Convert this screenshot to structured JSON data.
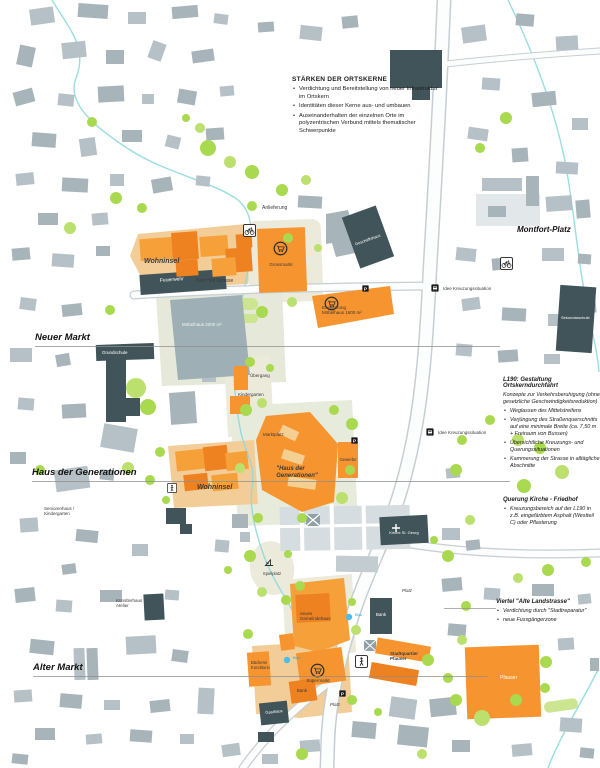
{
  "annotations": {
    "staerken": {
      "title": "STÄRKEN DER ORTSKERNE",
      "bullets": [
        "Verdichtung und Bereitstellung von neuer Infrastruktur im Ortskern",
        "Identitäten dieser Kerne aus- und umbauen",
        "Auseinanderhalten der einzelnen Orte im polyzentrischen Verbund mittels thematischer Schwerpunkte"
      ]
    },
    "l190": {
      "title": "L190: Gestaltung Ortskerndurchfahrt",
      "intro": "Konzepte zur Verkehrsberuhigung (ohne gesetzliche Geschwindigkeitsreduktion)",
      "bullets": [
        "Weglassen des Mittelstreifens",
        "Verjüngung des Straßenquerschnitts auf eine minimale Breite (ca. 7,50 m + Freiraum von Bussen)",
        "Übersichtliche Kreuzungs- und Querungssituationen",
        "Kammerung der Strasse in alltägliche Abschnitte"
      ]
    },
    "querung": {
      "title": "Querung Kirche - Friedhof",
      "bullets": [
        "Kreuzungsbereich auf der L190 in z.B. eingefärbtem Asphalt (Westteil C) oder Pflasterung"
      ]
    },
    "viertel": {
      "title": "Viertel \"Alte Landstrasse\"",
      "bullets": [
        "Verdichtung durch \"Stadtreparatur\"",
        "neue Fussgängerzone"
      ]
    }
  },
  "district_labels": [
    {
      "id": "neuer-markt",
      "t": "Neuer Markt",
      "x": 35,
      "y": 333,
      "lw": 465
    },
    {
      "id": "haus-der-generationen",
      "t": "Haus der Generationen",
      "x": 32,
      "y": 468,
      "lw": 478
    },
    {
      "id": "alter-markt",
      "t": "Alter Markt",
      "x": 33,
      "y": 663,
      "lw": 455
    },
    {
      "id": "montfort-platz",
      "t": "Montfort-Platz",
      "x": 517,
      "y": 226,
      "lw": 0,
      "small": 1
    }
  ],
  "map_labels": [
    {
      "t": "Feuerwehr",
      "x": 160,
      "y": 278,
      "s": 5,
      "c": "#ffffff",
      "r": -4
    },
    {
      "t": "Wohninsel",
      "x": 144,
      "y": 258,
      "s": 7,
      "b": 1,
      "i": 1
    },
    {
      "t": "Karl Höll Strasse",
      "x": 196,
      "y": 279,
      "s": 5
    },
    {
      "t": "Anlieferung",
      "x": 262,
      "y": 206,
      "s": 5
    },
    {
      "t": "Grossmarkt",
      "x": 281,
      "y": 262,
      "s": 4.5,
      "a": "center"
    },
    {
      "t": "Erweiterung\nMöbelhaus 1600 m²",
      "x": 322,
      "y": 305,
      "s": 4.5
    },
    {
      "t": "Möbelhaus 2000 m²",
      "x": 182,
      "y": 322,
      "s": 4.5,
      "c": "#f2f5f5"
    },
    {
      "t": "Geschäftshaus",
      "x": 368,
      "y": 238,
      "s": 4,
      "c": "#ffffff",
      "r": -20,
      "a": "center"
    },
    {
      "t": "Grundschule",
      "x": 102,
      "y": 350,
      "s": 4.5,
      "c": "#ffffff"
    },
    {
      "t": "Sekundarschule",
      "x": 561,
      "y": 316,
      "s": 4,
      "c": "#ffffff"
    },
    {
      "t": "Idee Kreuzungssituation",
      "x": 443,
      "y": 286,
      "s": 4.5
    },
    {
      "t": "Idee Kreuzungssituation",
      "x": 438,
      "y": 430,
      "s": 4.5
    },
    {
      "t": "Übergang",
      "x": 250,
      "y": 373,
      "s": 4.5
    },
    {
      "t": "Kindergarten",
      "x": 238,
      "y": 392,
      "s": 4.5
    },
    {
      "t": "Marktplatz",
      "x": 263,
      "y": 432,
      "s": 4.5
    },
    {
      "t": "\"Haus der\nGenerationen\"",
      "x": 297,
      "y": 466,
      "s": 6,
      "b": 1,
      "i": 1,
      "a": "center"
    },
    {
      "t": "Gewerbe",
      "x": 348,
      "y": 458,
      "s": 4.2,
      "a": "center"
    },
    {
      "t": "Wohninsel",
      "x": 197,
      "y": 484,
      "s": 7,
      "b": 1,
      "i": 1
    },
    {
      "t": "Seniorenhaus /\nKindergarten",
      "x": 44,
      "y": 506,
      "s": 4.5
    },
    {
      "t": "Spielplatz",
      "x": 272,
      "y": 572,
      "s": 4.2,
      "a": "center"
    },
    {
      "t": "Kirche St. Georg",
      "x": 404,
      "y": 531,
      "s": 4,
      "c": "#ffffff",
      "a": "center"
    },
    {
      "t": "Künstlerhaus\nAtelier",
      "x": 116,
      "y": 598,
      "s": 4.5
    },
    {
      "t": "neues\nGemeindehaus",
      "x": 300,
      "y": 611,
      "s": 4.5
    },
    {
      "t": "Bank",
      "x": 381,
      "y": 612,
      "s": 4.5,
      "c": "#ffffff",
      "a": "center"
    },
    {
      "t": "Bus",
      "x": 355,
      "y": 613,
      "s": 4,
      "c": "#2ea9d8"
    },
    {
      "t": "Bus",
      "x": 293,
      "y": 656,
      "s": 4,
      "c": "#2ea9d8"
    },
    {
      "t": "Supermarkt",
      "x": 318,
      "y": 678,
      "s": 4.5,
      "a": "center"
    },
    {
      "t": "Bäckerei\nKonditorei",
      "x": 251,
      "y": 661,
      "s": 4.2
    },
    {
      "t": "Bank",
      "x": 302,
      "y": 688,
      "s": 4.5,
      "a": "center"
    },
    {
      "t": "Platz",
      "x": 330,
      "y": 702,
      "s": 4.5,
      "i": 1
    },
    {
      "t": "Platz",
      "x": 402,
      "y": 588,
      "s": 4.5,
      "i": 1
    },
    {
      "t": "Gasthaus",
      "x": 274,
      "y": 710,
      "s": 4,
      "c": "#ffffff",
      "a": "center",
      "r": -6
    },
    {
      "t": "Stadtquartier\nPfauser",
      "x": 390,
      "y": 651,
      "s": 4.5,
      "b": 1
    },
    {
      "t": "Pfauser",
      "x": 500,
      "y": 676,
      "s": 5,
      "c": "#ffffff"
    }
  ],
  "poi_icons": [
    {
      "type": "cart",
      "x": 273,
      "y": 241
    },
    {
      "type": "cart",
      "x": 324,
      "y": 296
    },
    {
      "type": "cart",
      "x": 310,
      "y": 663
    },
    {
      "type": "bike",
      "x": 243,
      "y": 224
    },
    {
      "type": "bike",
      "x": 500,
      "y": 257
    },
    {
      "type": "ped",
      "x": 355,
      "y": 655
    },
    {
      "type": "ped-small",
      "x": 167,
      "y": 483
    },
    {
      "type": "parking",
      "x": 362,
      "y": 285
    },
    {
      "type": "parking",
      "x": 351,
      "y": 437
    },
    {
      "type": "parking",
      "x": 339,
      "y": 690
    },
    {
      "type": "bus-sign",
      "x": 431,
      "y": 284
    },
    {
      "type": "bus-sign",
      "x": 426,
      "y": 428
    },
    {
      "type": "bus-stop",
      "x": 345,
      "y": 613
    },
    {
      "type": "bus-stop",
      "x": 283,
      "y": 656
    },
    {
      "type": "play",
      "x": 263,
      "y": 556
    }
  ],
  "colors": {
    "new_intervention_orange": "#f6952f",
    "public_building_dark": "#40545a",
    "generic_building_grey": "#b5c1c6",
    "tree_green": "#a9d94f",
    "ground_tan": "#f3cd97",
    "ground_beige": "#eceadb",
    "stream_cyan": "#8fd9dd",
    "bus_stop_blue": "#49bfe8"
  }
}
